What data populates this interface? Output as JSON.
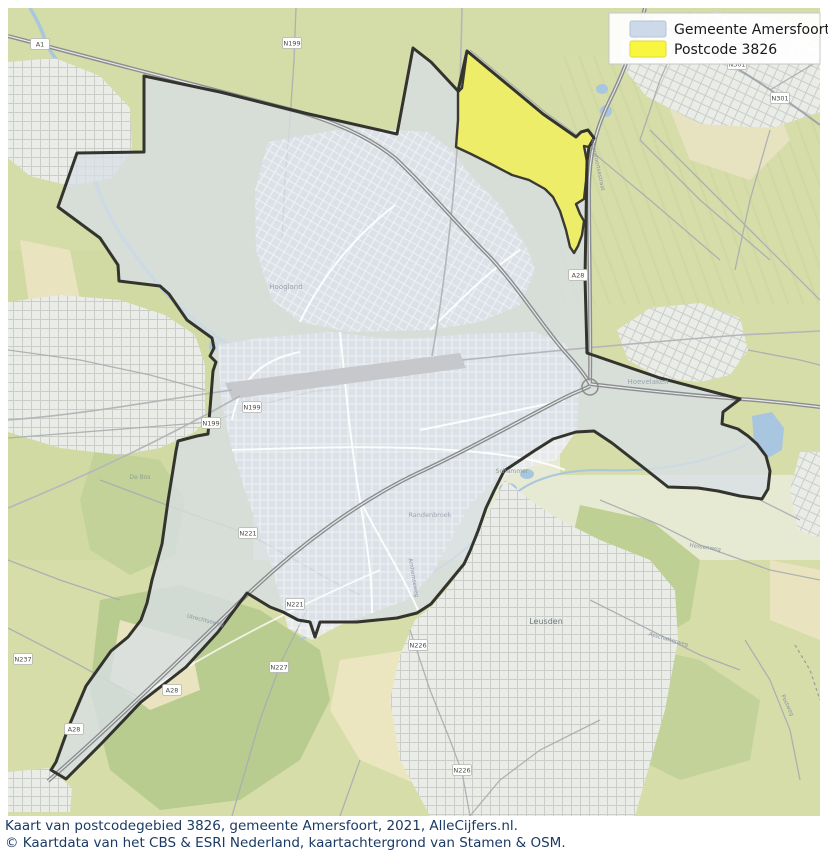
{
  "legend": {
    "items": [
      {
        "label": "Gemeente Amersfoort",
        "swatch_color": "#ccd9e9",
        "swatch_border": "#b7c4d6"
      },
      {
        "label": "Postcode 3826",
        "swatch_color": "#f8f640",
        "swatch_border": "#e0de30"
      }
    ]
  },
  "caption": {
    "line1": "Kaart van postcodegebied 3826, gemeente Amersfoort, 2021, AlleCijfers.nl.",
    "line2": "© Kaartdata van het CBS & ESRI Nederland, kaartachtergrond van Stamen & OSM.",
    "color": "#1b3a63"
  },
  "map": {
    "region_names": {
      "municipality": "Gemeente Amersfoort",
      "postcode": "Postcode 3826"
    },
    "colors": {
      "boundary": "#34342e",
      "municipality_fill": "rgba(215,223,230,0.78)",
      "postcode_fill": "#f0ee5f",
      "water": "#a9c6e0",
      "terrain_green": "#d4dca7"
    },
    "place_labels": [
      {
        "text": "Hoogland",
        "x": 286,
        "y": 289,
        "size": 7,
        "color": "#9aa3ad",
        "rotate": 0
      },
      {
        "text": "Randenbroek",
        "x": 430,
        "y": 517,
        "size": 6.5,
        "color": "#9aa3ad",
        "rotate": 0
      },
      {
        "text": "Schammer",
        "x": 512,
        "y": 473,
        "size": 6,
        "color": "#8fa08f",
        "rotate": 0
      },
      {
        "text": "Leusden",
        "x": 546,
        "y": 624,
        "size": 8,
        "color": "#6e7880",
        "rotate": 0
      },
      {
        "text": "De Bos",
        "x": 140,
        "y": 479,
        "size": 6,
        "color": "#8fa08f",
        "rotate": 0
      },
      {
        "text": "Hoevelaken",
        "x": 648,
        "y": 384,
        "size": 7,
        "color": "#9aa3ad",
        "rotate": 0
      },
      {
        "text": "Utrechtseweg",
        "x": 205,
        "y": 622,
        "size": 5.5,
        "color": "#8a93a0",
        "rotate": 14
      },
      {
        "text": "Hessenweg",
        "x": 705,
        "y": 549,
        "size": 5.5,
        "color": "#8a93a0",
        "rotate": 8
      },
      {
        "text": "Asschatterweg",
        "x": 668,
        "y": 641,
        "size": 5.5,
        "color": "#8a93a0",
        "rotate": 16
      },
      {
        "text": "Postweg",
        "x": 786,
        "y": 706,
        "size": 5.5,
        "color": "#8a93a0",
        "rotate": 65
      },
      {
        "text": "Arnhemseweg",
        "x": 412,
        "y": 578,
        "size": 5.5,
        "color": "#8a93a0",
        "rotate": 80
      },
      {
        "text": "Amersfoortsestraat",
        "x": 596,
        "y": 165,
        "size": 5.5,
        "color": "#8a93a0",
        "rotate": 78
      }
    ],
    "road_shields": [
      {
        "text": "A1",
        "x": 40,
        "y": 44
      },
      {
        "text": "A28",
        "x": 578,
        "y": 275
      },
      {
        "text": "A28",
        "x": 74,
        "y": 729
      },
      {
        "text": "A28",
        "x": 172,
        "y": 690
      },
      {
        "text": "N199",
        "x": 292,
        "y": 43
      },
      {
        "text": "N199",
        "x": 252,
        "y": 407
      },
      {
        "text": "N199",
        "x": 211,
        "y": 423
      },
      {
        "text": "N221",
        "x": 248,
        "y": 533
      },
      {
        "text": "N221",
        "x": 295,
        "y": 604
      },
      {
        "text": "N226",
        "x": 418,
        "y": 645
      },
      {
        "text": "N226",
        "x": 462,
        "y": 770
      },
      {
        "text": "N227",
        "x": 279,
        "y": 667
      },
      {
        "text": "N237",
        "x": 23,
        "y": 659
      },
      {
        "text": "N301",
        "x": 737,
        "y": 64
      },
      {
        "text": "N301",
        "x": 780,
        "y": 98
      }
    ]
  }
}
